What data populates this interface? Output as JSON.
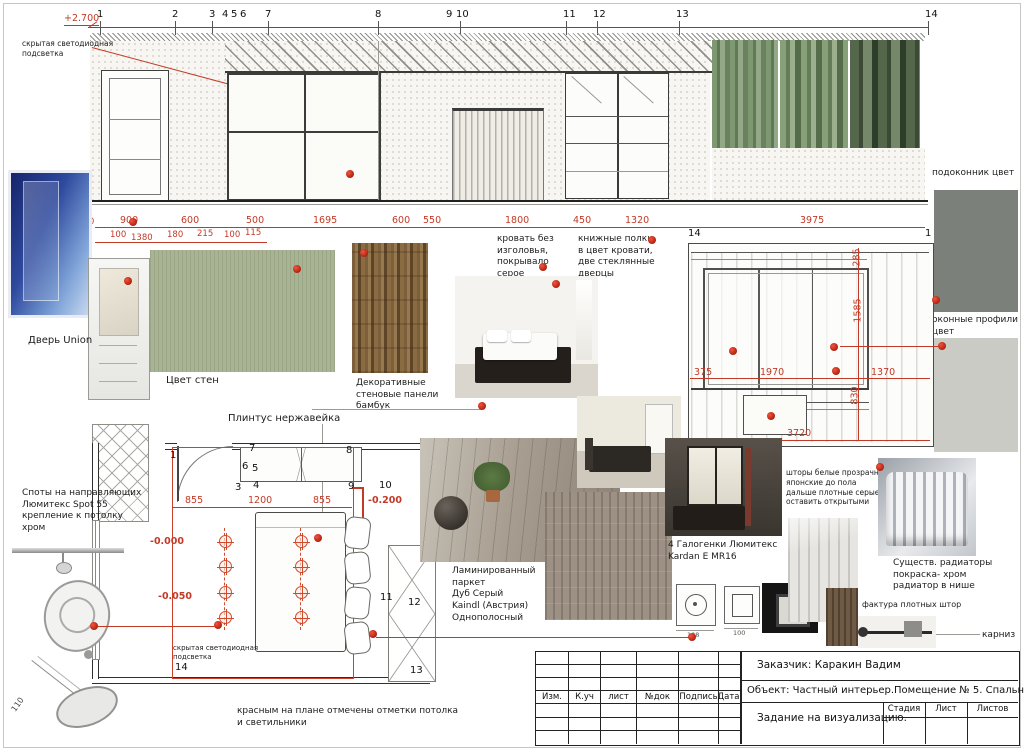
{
  "grid_top": [
    "1",
    "2",
    "3",
    "4",
    "5",
    "6",
    "7",
    "8",
    "9",
    "10",
    "11",
    "12",
    "13",
    "14"
  ],
  "elevation": {
    "level_ceiling": "+2.700",
    "level_floor": "+0.000",
    "dim_100_left": "100",
    "led_note": "скрытая светодиодная\nподсветка",
    "dims_row1": [
      "900",
      "600",
      "500",
      "1695",
      "600",
      "550",
      "1800",
      "450",
      "1320",
      "3975"
    ],
    "dims_row2": [
      "100",
      "1380",
      "180",
      "215",
      "100",
      "115"
    ]
  },
  "window_wall": {
    "grid_left": "14",
    "grid_right": "1",
    "v_dims": [
      "285",
      "1585",
      "830"
    ],
    "h_dims": [
      "375",
      "1970",
      "1370"
    ],
    "total": "3720",
    "curtains_note": "шторы белые прозрачные\nяпонские до пола\nдальше плотные серые,\nоставить открытыми"
  },
  "materials": {
    "door_label": "Дверь Union",
    "wall_color_label": "Цвет стен",
    "bamboo_label": "Декоративные\nстеновые панели\nбамбук",
    "plinth_label": "Плинтус нержавейка",
    "sill_label": "подоконник цвет",
    "profiles_label": "оконные профили\nцвет",
    "laminate_label": "Ламинированный паркет\nДуб Серый\nKaindl (Австрия)\nОднополосный",
    "curtain_texture_label": "фактура плотных штор",
    "cornice_label": "карниз",
    "radiators_label": "Существ. радиаторы\nпокраска- хром\nрадиатор в нише"
  },
  "furniture_notes": {
    "bed": "кровать без\nизголовья,\nпокрывало серое",
    "shelves": "книжные полки,\nв цвет кровати,\nдве стеклянные\nдверцы"
  },
  "lighting": {
    "spots_label": "Споты на направляющих\nЛюмитекс Spot 55\nкрепление к потолку\nхром",
    "halogen_label": "4 Галогенки Люмитекс\nKardan E MR16",
    "fixture_dim_a": "108",
    "fixture_dim_b": "100",
    "pendant_dim": "110"
  },
  "plan": {
    "dims": [
      "855",
      "1200",
      "855"
    ],
    "levels": {
      "l200": "-0.200",
      "l000": "-0.000",
      "l050": "-0.050"
    },
    "led_note": "скрытая светодиодная\nподсветка",
    "grid": {
      "g1": "1",
      "g3": "3",
      "g4": "4",
      "g5": "5",
      "g6": "6",
      "g7": "7",
      "g8": "8",
      "g9": "9",
      "g10": "10",
      "g11": "11",
      "g12": "12",
      "g13": "13",
      "g14": "14"
    },
    "note": "красным на плане отмечены отметки потолка\nи светильники"
  },
  "titleblock": {
    "client": "Заказчик: Каракин Вадим",
    "object": "Объект: Частный интерьер.Помещение № 5. Спальня М 1:40",
    "task": "Задание на визуализацию.",
    "rev_cols": [
      "Изм.",
      "К.уч",
      "лист",
      "№док",
      "Подпись",
      "Дата"
    ],
    "stage_cols": [
      "Стадия",
      "Лист",
      "Листов"
    ]
  },
  "colors": {
    "dim_red": "#c23a26",
    "marker_red": "#cf2a16",
    "wall_green": "#a9b494",
    "sill_gray": "#7c807b",
    "profile_gray": "#cbcbc6"
  }
}
